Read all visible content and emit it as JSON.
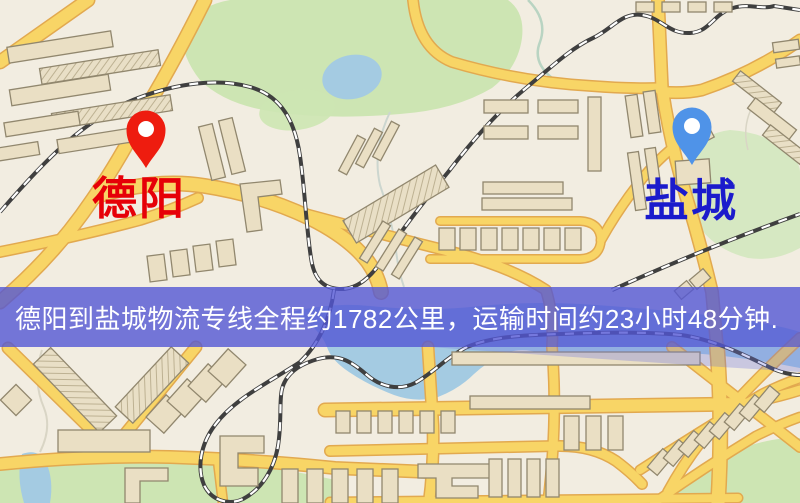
{
  "banner": {
    "text": "德阳到盐城物流专线全程约1782公里，运输时间约23小时48分钟.",
    "background_color": "#5256d5",
    "text_color": "#ffffff",
    "route": {
      "origin": "德阳",
      "destination": "盐城",
      "distance_km": "1782",
      "duration_hours": "23",
      "duration_minutes": "48"
    }
  },
  "markers": {
    "origin": {
      "label": "德阳",
      "pin_color": "#ee1c0f",
      "label_color": "#e60008"
    },
    "destination": {
      "label": "盐城",
      "pin_color": "#4f93e8",
      "label_color": "#1b1bcc"
    }
  },
  "map": {
    "background_color": "#f2ede1",
    "road_color": "#f8d566",
    "road_casing_color": "#e2a94f",
    "park_color": "#cde5b3",
    "water_color": "#a4cbe2",
    "railway_color": "#3f3f3f",
    "building_color": "#eadfc4"
  }
}
